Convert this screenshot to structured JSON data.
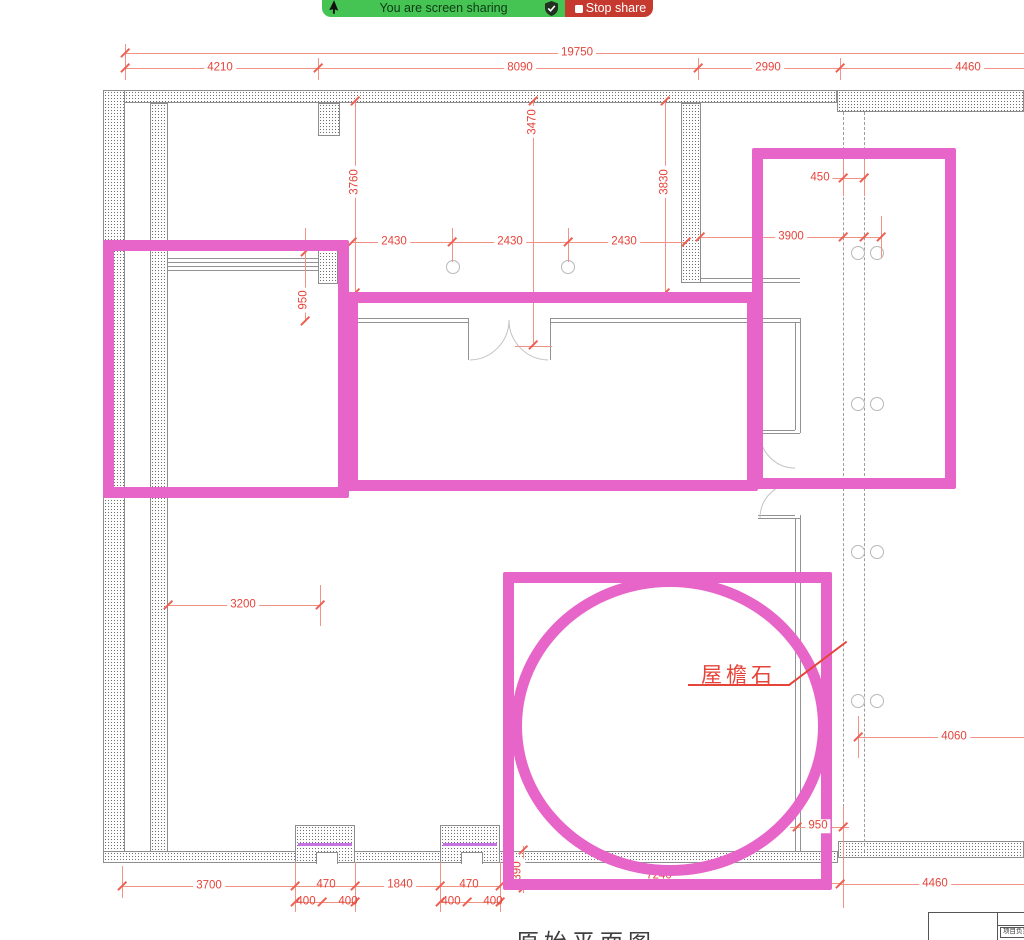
{
  "banner": {
    "sharing_label": "You are screen sharing",
    "stop_label": "Stop share",
    "green_color": "#45c353",
    "red_color": "#c5392e"
  },
  "plan": {
    "dimension_color": "#e5443a",
    "annotation_color": "#e764c8",
    "pier_line_color": "#c573e2",
    "dims": {
      "top_overall": "19750",
      "top_seg1": "4210",
      "top_seg2": "8090",
      "top_seg3": "2990",
      "top_seg4": "4460",
      "v_left": "3760",
      "v_mid": "3470",
      "v_right": "3830",
      "bay1": "2430",
      "bay2": "2430",
      "bay3": "2430",
      "offset_450": "450",
      "span_3900": "3900",
      "sill_950": "950",
      "span_3200": "3200",
      "span_4060": "4060",
      "gap_950": "950",
      "bot_3700": "3700",
      "bot_470a": "470",
      "bot_1840": "1840",
      "bot_470b": "470",
      "bot_400a": "400",
      "bot_400b": "400",
      "bot_400c": "400",
      "bot_400d": "400",
      "v_390": "390",
      "bot_7240": "7240",
      "bot_4460": "4460"
    },
    "labels": {
      "eaves_stone": "屋檐石",
      "caption": "原始平面图",
      "title_block_cell": "项目负责"
    }
  }
}
